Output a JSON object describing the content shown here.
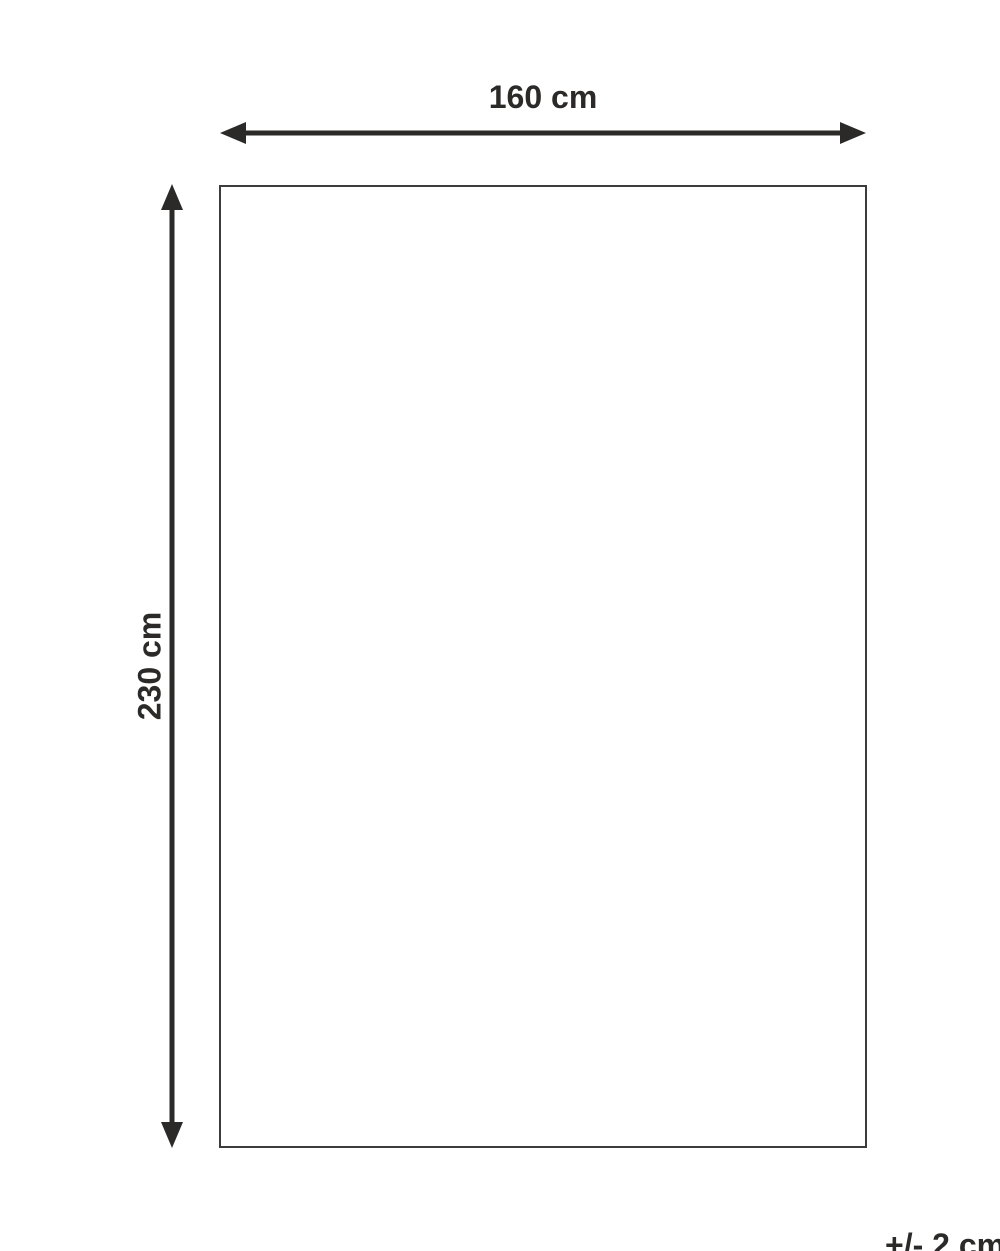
{
  "diagram": {
    "type": "product-dimension-diagram",
    "width_label": "160 cm",
    "height_label": "230 cm",
    "tolerance_label": "+/- 2 cm"
  },
  "colors": {
    "arrow_and_text": "#2b2a29",
    "outline": "#3c3c3b",
    "background": "#ffffff"
  }
}
